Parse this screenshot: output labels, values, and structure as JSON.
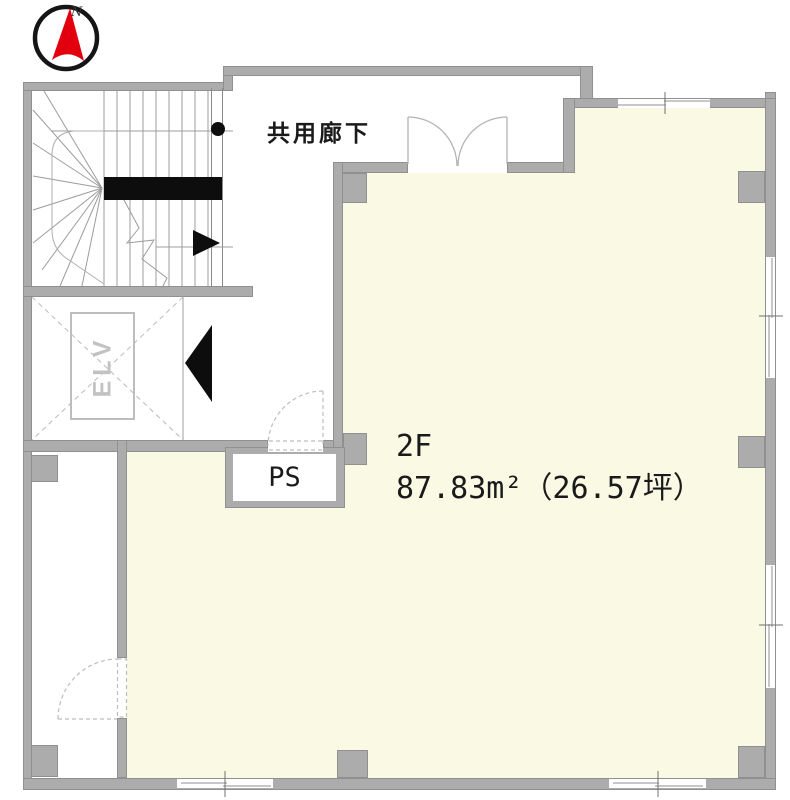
{
  "title": "2F floor plan",
  "compass": {
    "north_label": "N"
  },
  "labels": {
    "common_corridor": "共用廊下",
    "floor": "2F",
    "area": "87.83m²（26.57坪）",
    "pipe_shaft": "PS",
    "elevator": "ELV"
  },
  "colors": {
    "room_fill": "#FAF9E4",
    "wall_fill": "#ACACAC",
    "wall_edge": "#909090",
    "compass_red": "#E2000F",
    "marker_black": "#0D0D0D",
    "text_color": "#1A1A1A"
  }
}
